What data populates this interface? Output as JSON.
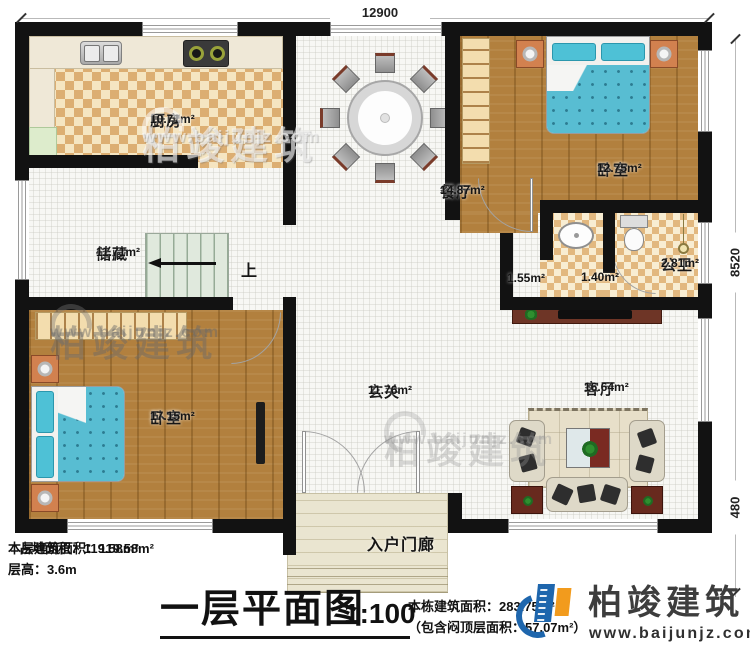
{
  "plan": {
    "dim_top": "12900",
    "dim_right_main": "8520",
    "dim_right_porch": "480",
    "stairs_up": "上",
    "rooms": [
      {
        "name": "厨房",
        "area": "10.71m²"
      },
      {
        "name": "餐厅",
        "area": "14.87m²"
      },
      {
        "name": "卧室",
        "area": "12.75m²"
      },
      {
        "name": "储藏",
        "area": "11.71m²"
      },
      {
        "name": "",
        "area": "1.55m²"
      },
      {
        "name": "",
        "area": "1.40m²"
      },
      {
        "name": "公卫",
        "area": "2.81m²"
      },
      {
        "name": "卧室",
        "area": "17.15m²"
      },
      {
        "name": "玄关",
        "area": "11.76m²"
      },
      {
        "name": "客厅",
        "area": "16.64m²"
      },
      {
        "name": "入户门廊",
        "area": ""
      }
    ]
  },
  "footer": {
    "stat_floor_area": "本层建筑面积：119.58m²",
    "stat_ground_area": "占地面积：119.58m²",
    "stat_floor_height": "层高：3.6m",
    "title": "一层平面图",
    "scale": "1:100",
    "stat_total_area": "本栋建筑面积：283.75m²",
    "stat_attic_area": "（包含闷顶层面积：57.07m²）"
  },
  "brand": {
    "name": "柏竣建筑",
    "url": "www.baijunjz.com"
  },
  "colors": {
    "wall": "#121212",
    "accent_blue": "#1e66ad",
    "accent_orange": "#f29b1d",
    "bed_teal": "#58bdd2",
    "checker_dark": "#dcae72"
  }
}
